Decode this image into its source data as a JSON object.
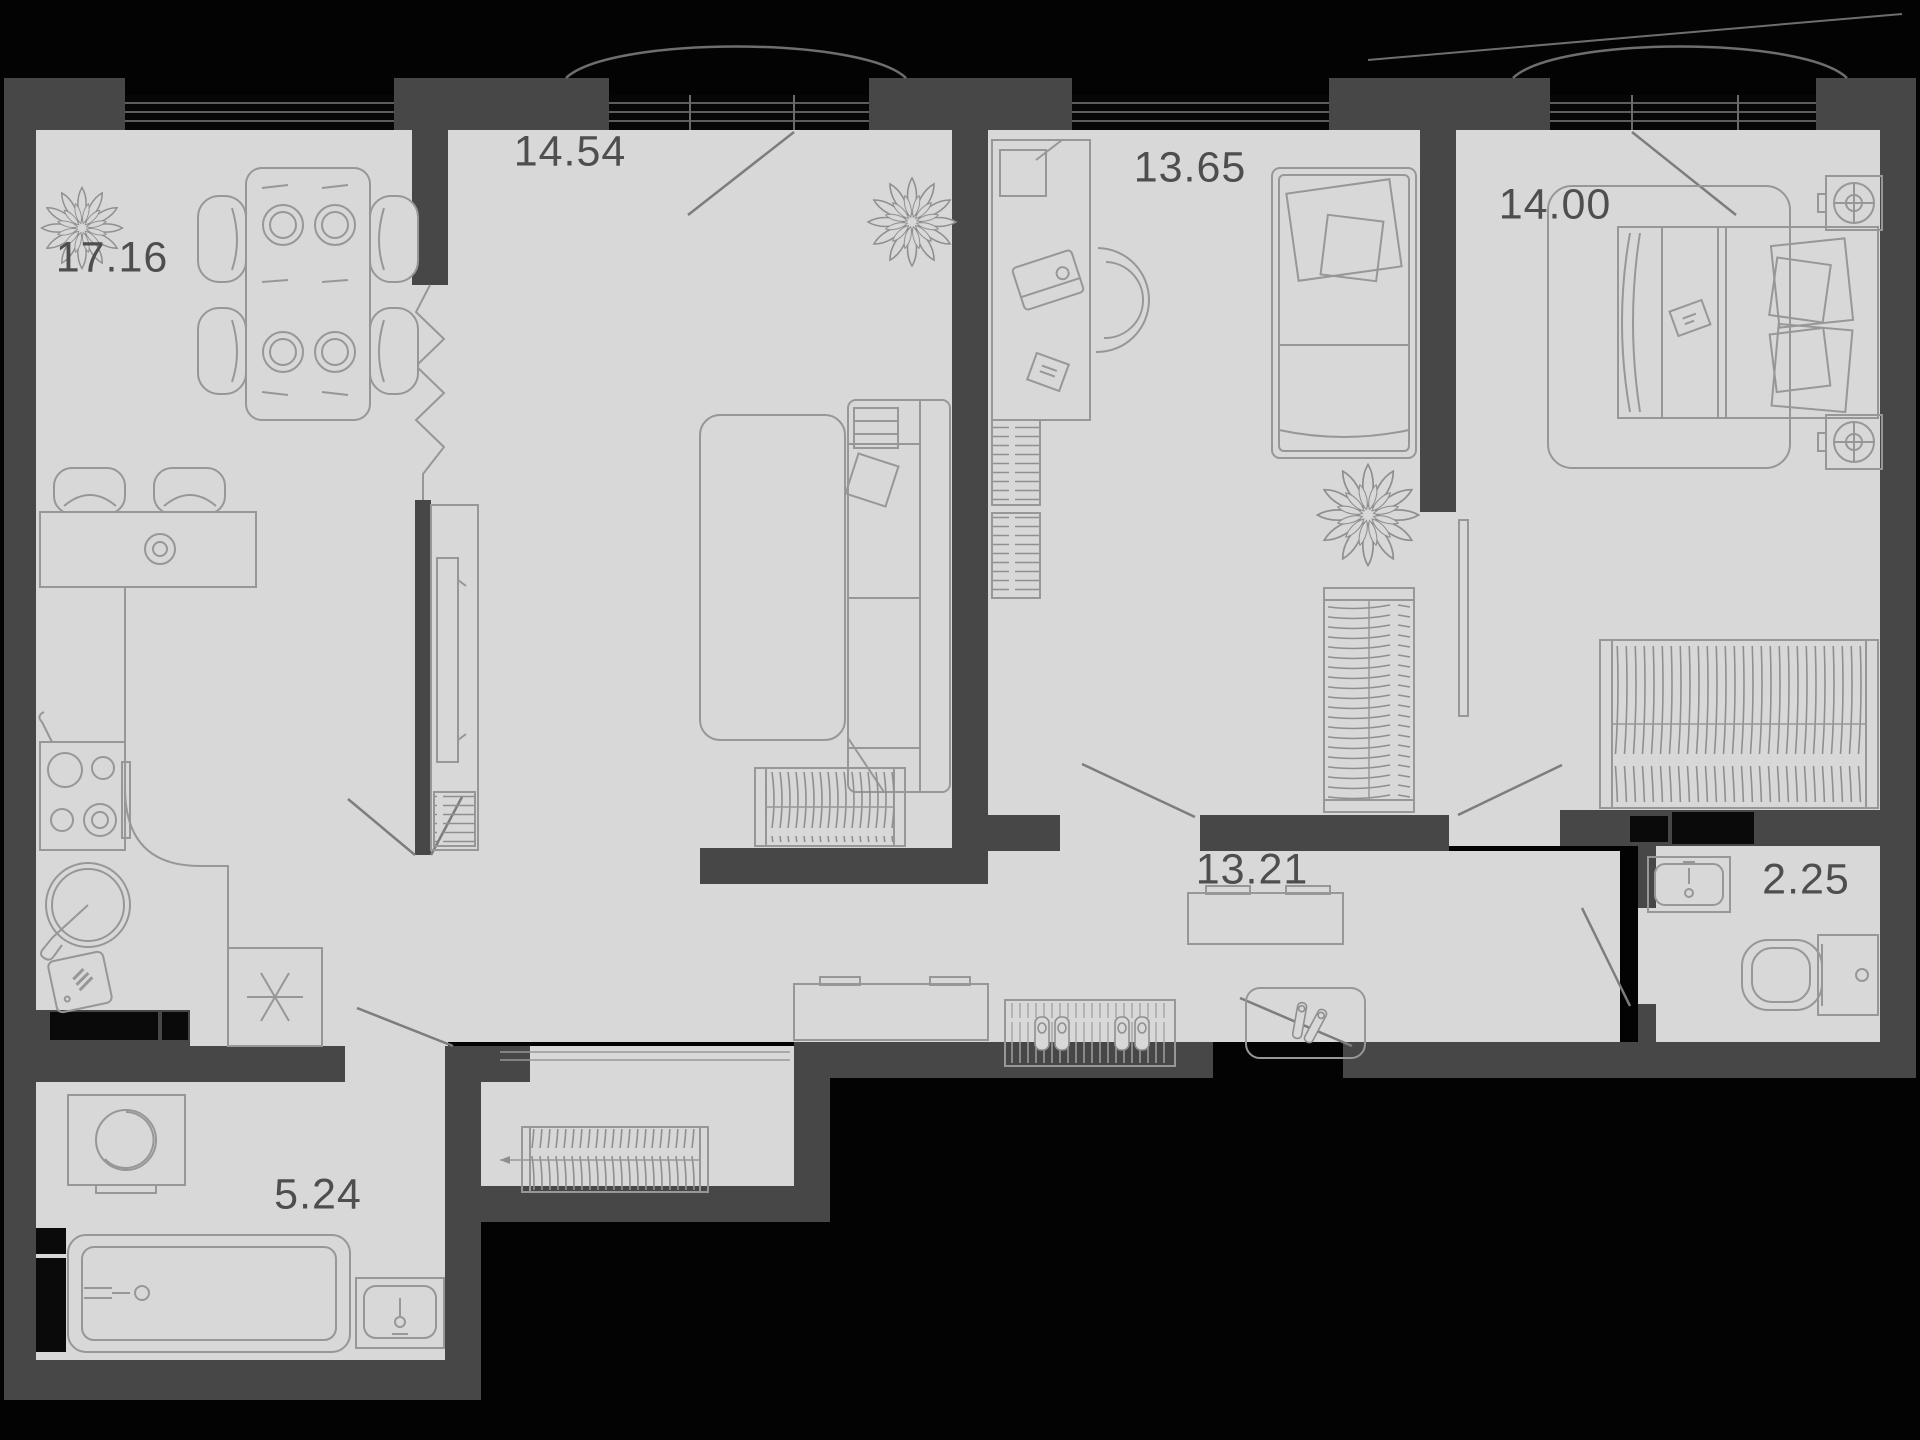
{
  "plan_type": "apartment-floor-plan",
  "rooms": [
    {
      "id": "kitchen-dining",
      "area_label": "17.16"
    },
    {
      "id": "living-room",
      "area_label": "14.54"
    },
    {
      "id": "bedroom-small",
      "area_label": "13.65"
    },
    {
      "id": "bedroom-master",
      "area_label": "14.00"
    },
    {
      "id": "hallway",
      "area_label": "13.21"
    },
    {
      "id": "wc",
      "area_label": "2.25"
    },
    {
      "id": "bathroom",
      "area_label": "5.24"
    }
  ],
  "icons": [
    "plant-icon",
    "dining-table-icon",
    "chair-icon",
    "bar-counter-icon",
    "bar-stool-icon",
    "stove-icon",
    "kitchen-sink-icon",
    "cutting-board-icon",
    "fridge-icon",
    "sofa-icon",
    "rug-icon",
    "tv-console-icon",
    "bookshelf-icon",
    "wardrobe-hangers-icon",
    "desk-icon",
    "desk-chair-icon",
    "single-bed-icon",
    "double-bed-icon",
    "bedside-unit-icon",
    "console-table-icon",
    "shoe-mat-icon",
    "slippers-icon",
    "heels-icon",
    "radiator-icon",
    "washing-machine-icon",
    "bathtub-icon",
    "sink-icon",
    "toilet-icon",
    "window-icon",
    "balcony-arc-icon",
    "door-swing-icon",
    "zigzag-opening-icon",
    "vent-shaft-icon"
  ],
  "colors": {
    "background": "#030303",
    "floor": "#d8d8d8",
    "wall": "#474747",
    "furniture_line": "#979797",
    "label_text": "#4e4e4e"
  }
}
